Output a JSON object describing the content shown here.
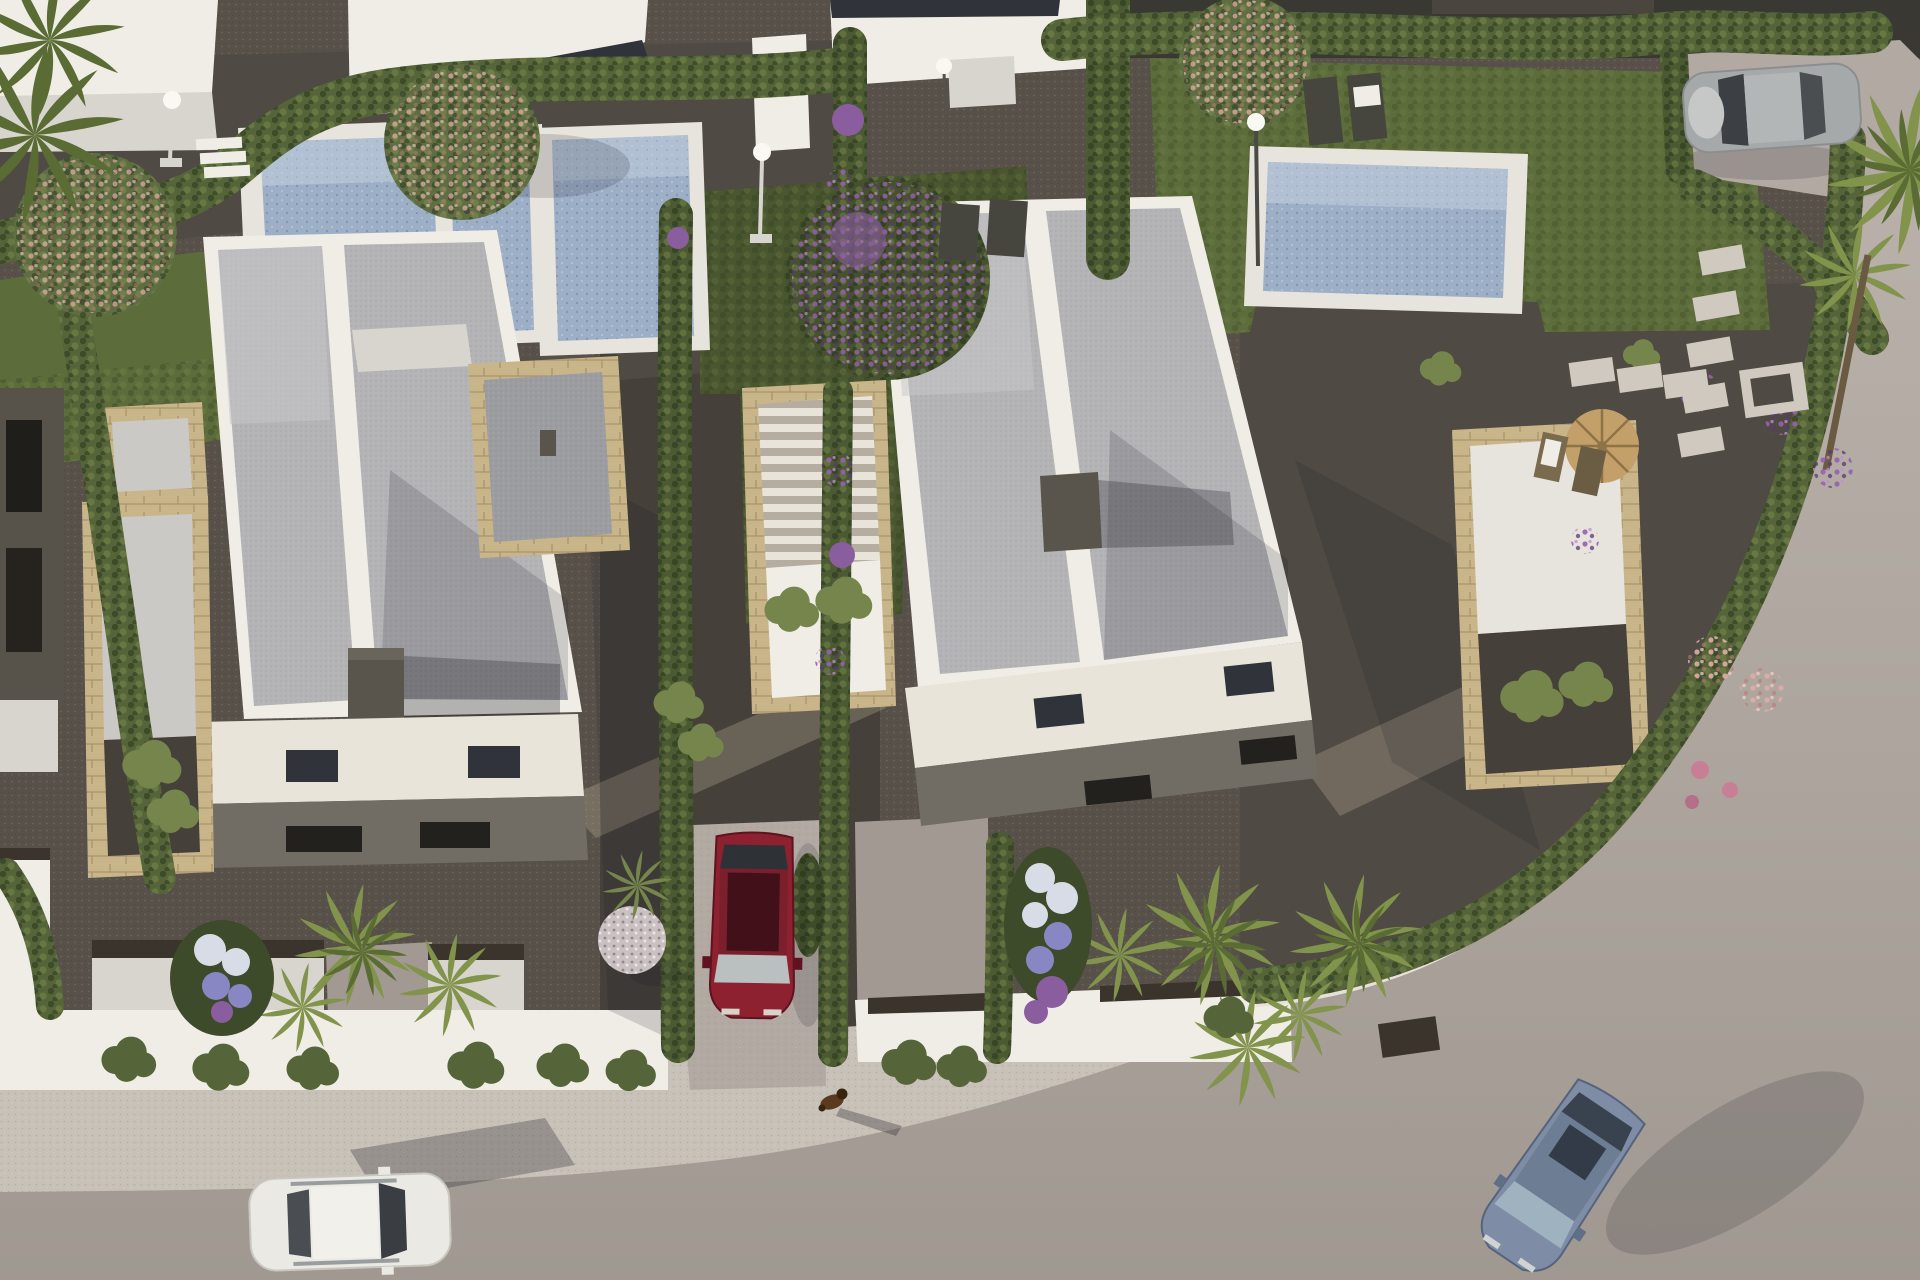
{
  "scene": {
    "type": "aerial-3d-architectural-render",
    "description": "Top-down aerial rendering of a modern residential development: two white flat-roof duplex villas with stone-clad wings, four private swimming pools with white decks, landscaped gravel gardens with cypress hedges, palms and flowering trees, a curved street with sidewalk, four cars and a dog"
  },
  "objects": {
    "villas": 2,
    "pools": 4,
    "dog": 1,
    "cars": [
      {
        "color-name": "white",
        "location": "street bottom-left"
      },
      {
        "color-name": "dark-red",
        "location": "driveway center"
      },
      {
        "color-name": "steel-blue",
        "location": "street bottom-right"
      },
      {
        "color-name": "silver",
        "location": "parking pad top-right"
      }
    ]
  },
  "palette": {
    "base": "#57514a",
    "gravelDark": "#45403a",
    "gravelMid": "#4f4a43",
    "gravelLight": "#6e665c",
    "road": "#b2aaa2",
    "roadLow": "#a29a92",
    "sidewalk": "#c8c1b7",
    "curb": "#e3dfd7",
    "wallWhite": "#f0ede6",
    "wallBright": "#faf8f3",
    "wallShade": "#d8d5cf",
    "cream": "#e9e4d9",
    "facadeShade": "#716c64",
    "roofGravel": "#b4b4b7",
    "roofLight": "#c7c7c9",
    "roofShade": "#9b9da1",
    "stone": "#c9b58a",
    "stoneShade": "#ad9a70",
    "terrace": "#cac9c5",
    "poolDeck": "#e7e4dd",
    "water": "#9dafc7",
    "waterLight": "#c7d2e0",
    "grass": "#5d6c3b",
    "grassShade": "#49562f",
    "hedge": "#556439",
    "hedgeDark": "#3e4b2a",
    "hedgeLight": "#75854c",
    "cypress": "#4b5a32",
    "canopy": "#5f6e42",
    "canopyDark": "#46522f",
    "pink": "#d9aba3",
    "purple": "#8a5d9e",
    "palm": "#82934b",
    "palmDark": "#5a6b34",
    "trunk": "#6b5a42",
    "flowerWhite": "#d8dce7",
    "flowerBlue": "#8987c3",
    "pebble": "#c9c0c1",
    "wicker": "#c3a069",
    "lounger": "#46463f",
    "chimney": "#5a554c",
    "gate": "#3a342c",
    "glass": "#30343a",
    "carRed": "#8d2130",
    "carRedDark": "#5f1220",
    "carWhite": "#ebe9e3",
    "carBlue": "#7e8da5",
    "carBlueDark": "#5f6f88",
    "carSilver": "#a6a9aa",
    "dogBrown": "#5c3a20",
    "dogDark": "#39240f",
    "shadow": "rgba(25,26,35,0.28)",
    "shadowSoft": "rgba(25,26,35,0.16)",
    "sun": "rgba(238,219,188,0.22)"
  }
}
